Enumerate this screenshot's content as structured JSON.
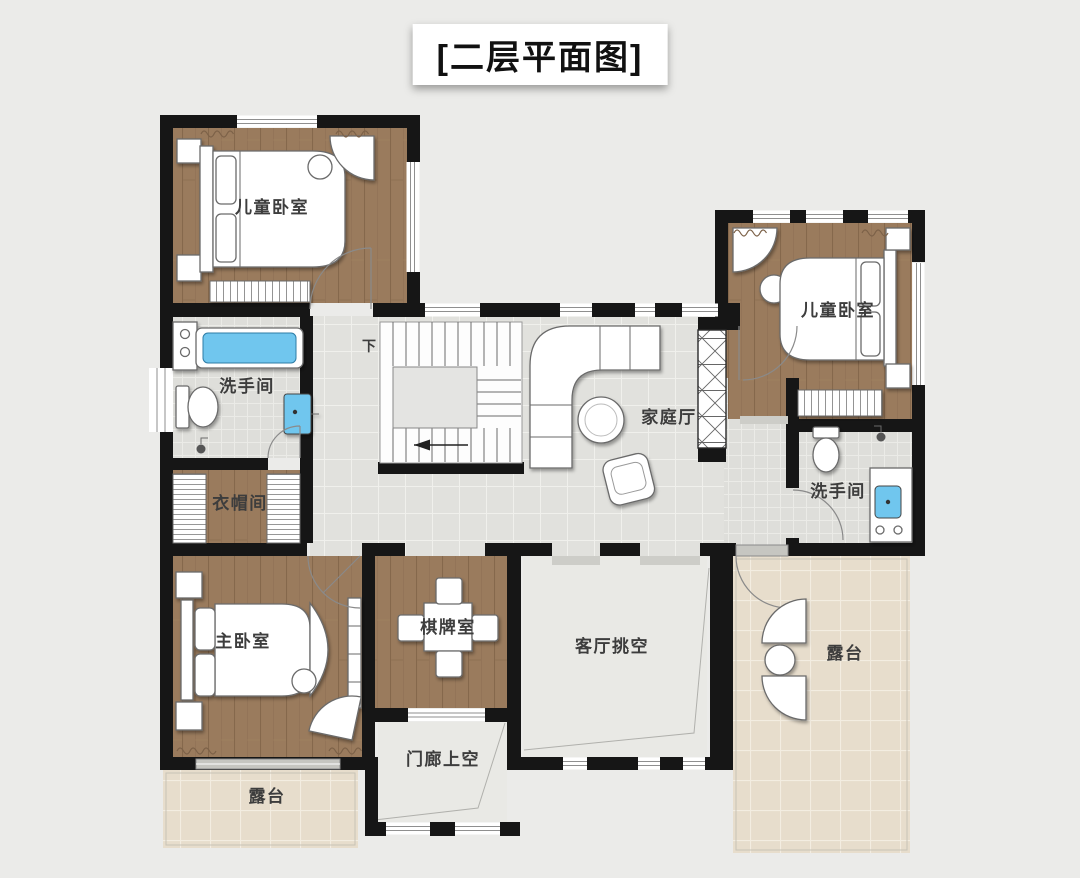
{
  "title": "[二层平面图]",
  "rooms": {
    "children_bedroom_left": {
      "label": "儿童卧室"
    },
    "children_bedroom_right": {
      "label": "儿童卧室"
    },
    "bathroom_left": {
      "label": "洗手间"
    },
    "bathroom_right": {
      "label": "洗手间"
    },
    "cloakroom": {
      "label": "衣帽间"
    },
    "family_hall": {
      "label": "家庭厅"
    },
    "master_bedroom": {
      "label": "主卧室"
    },
    "chess_room": {
      "label": "棋牌室"
    },
    "living_room_void": {
      "label": "客厅挑空"
    },
    "porch_void": {
      "label": "门廊上空"
    },
    "terrace_right": {
      "label": "露台"
    },
    "terrace_bottom": {
      "label": "露台"
    }
  },
  "stairs": {
    "down_label": "下"
  },
  "colors": {
    "background": "#ebebe9",
    "wall": "#161616",
    "wood_floor": "#9a7b5d",
    "hall_tile": "#e1e1dd",
    "bath_tile": "#dededa",
    "terrace_tile": "#e7ddcc",
    "void_floor": "#e9e9e5",
    "fixture_blue": "#6fc6ee",
    "furniture": "#ffffff",
    "label_text": "#3d3d3d"
  }
}
